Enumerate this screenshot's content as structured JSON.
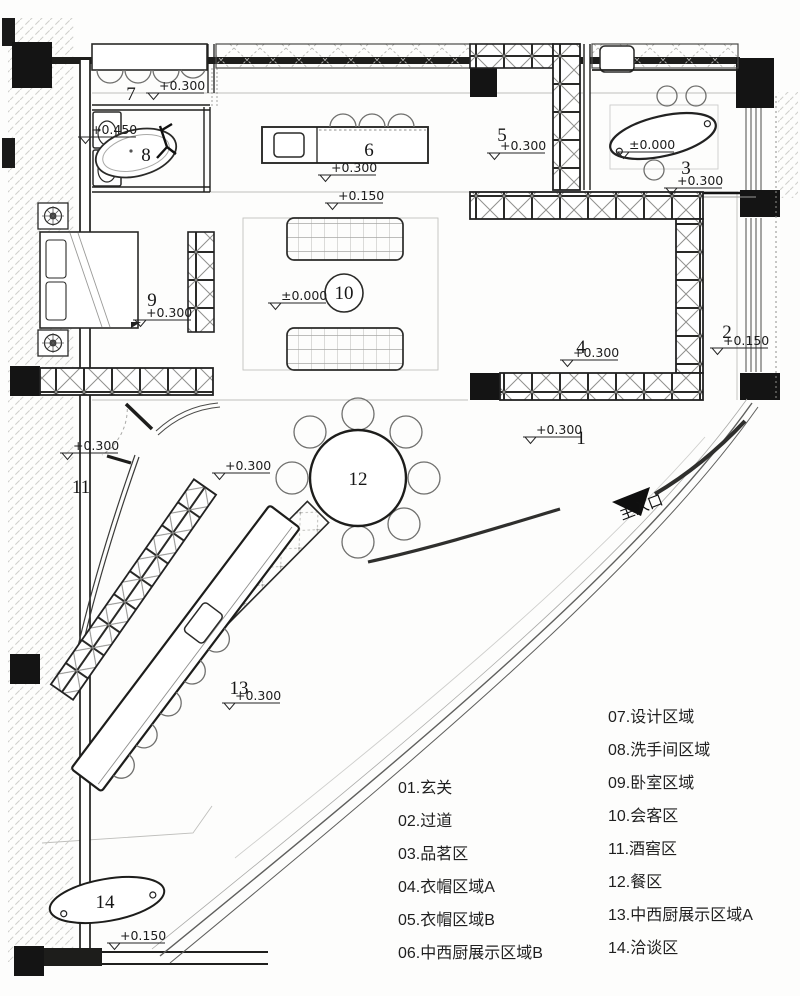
{
  "plan": {
    "entrance_label": "主入口",
    "area_numbers": {
      "a1": "1",
      "a2": "2",
      "a3": "3",
      "a4": "4",
      "a5": "5",
      "a6": "6",
      "a7": "7",
      "a8": "8",
      "a9": "9",
      "a10": "10",
      "a11": "11",
      "a12": "12",
      "a13": "13",
      "a14": "14"
    },
    "elevations": {
      "design": "+0.300",
      "bath": "+0.450",
      "island": "+0.300",
      "living_step": "+0.150",
      "living": "±0.000",
      "cloak_b": "+0.300",
      "tea_table": "±0.000",
      "tea": "+0.300",
      "cloak_a": "+0.300",
      "corridor": "+0.150",
      "bedroom": "+0.300",
      "wine": "+0.300",
      "wine_door": "+0.300",
      "hall": "+0.300",
      "display_a": "+0.300",
      "meeting": "+0.150"
    }
  },
  "legend": {
    "left": [
      "01.玄关",
      "02.过道",
      "03.品茗区",
      "04.衣帽区域A",
      "05.衣帽区域B",
      "06.中西厨展示区域B"
    ],
    "right": [
      "07.设计区域",
      "08.洗手间区域",
      "09.卧室区域",
      "10.会客区",
      "11.酒窖区",
      "12.餐区",
      "13.中西厨展示区域A",
      "14.洽谈区"
    ]
  }
}
